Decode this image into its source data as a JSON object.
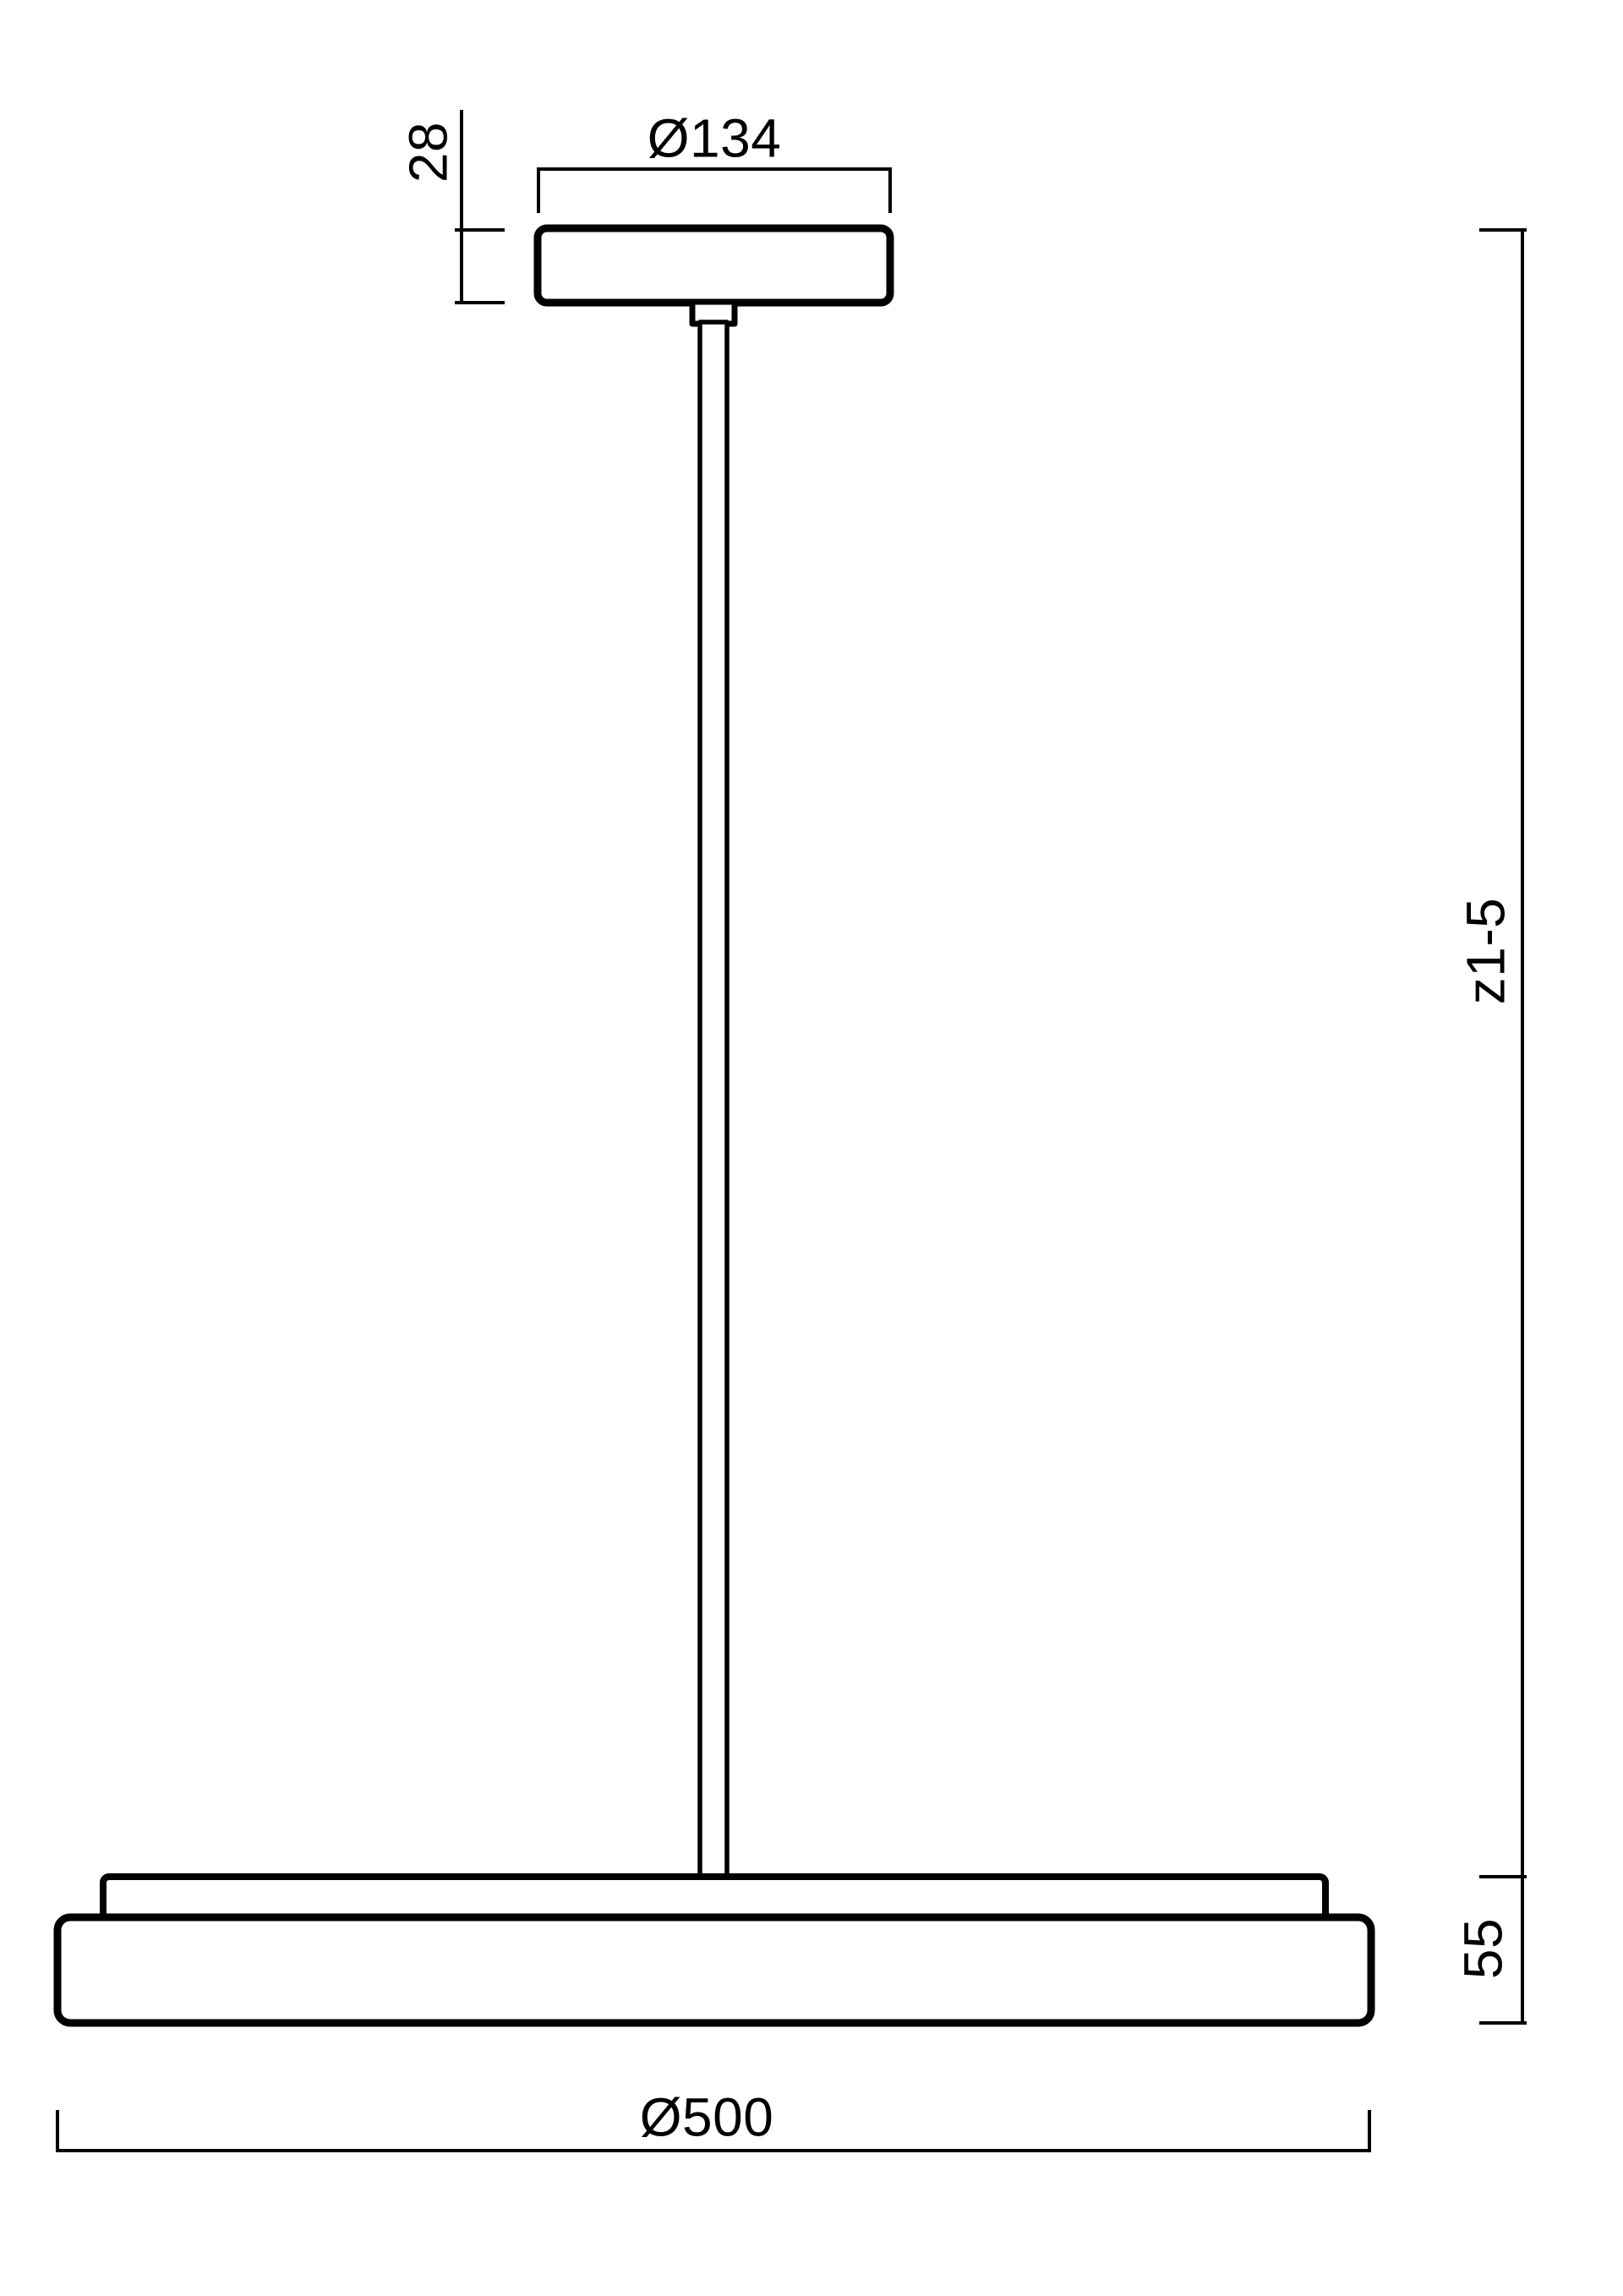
{
  "drawing": {
    "type": "pendant-luminaire-dimension-diagram",
    "background_color": "#ffffff",
    "line_color": "#000000",
    "labels": {
      "canopy_diameter": "Ø134",
      "canopy_height": "28",
      "suspension_length": "z1-5",
      "fixture_height": "55",
      "fixture_diameter": "Ø500"
    },
    "dimensions_mm": {
      "canopy_diameter": 134,
      "canopy_height": 28,
      "suspension_length_range": "z1-5",
      "fixture_height": 55,
      "fixture_diameter": 500
    }
  }
}
